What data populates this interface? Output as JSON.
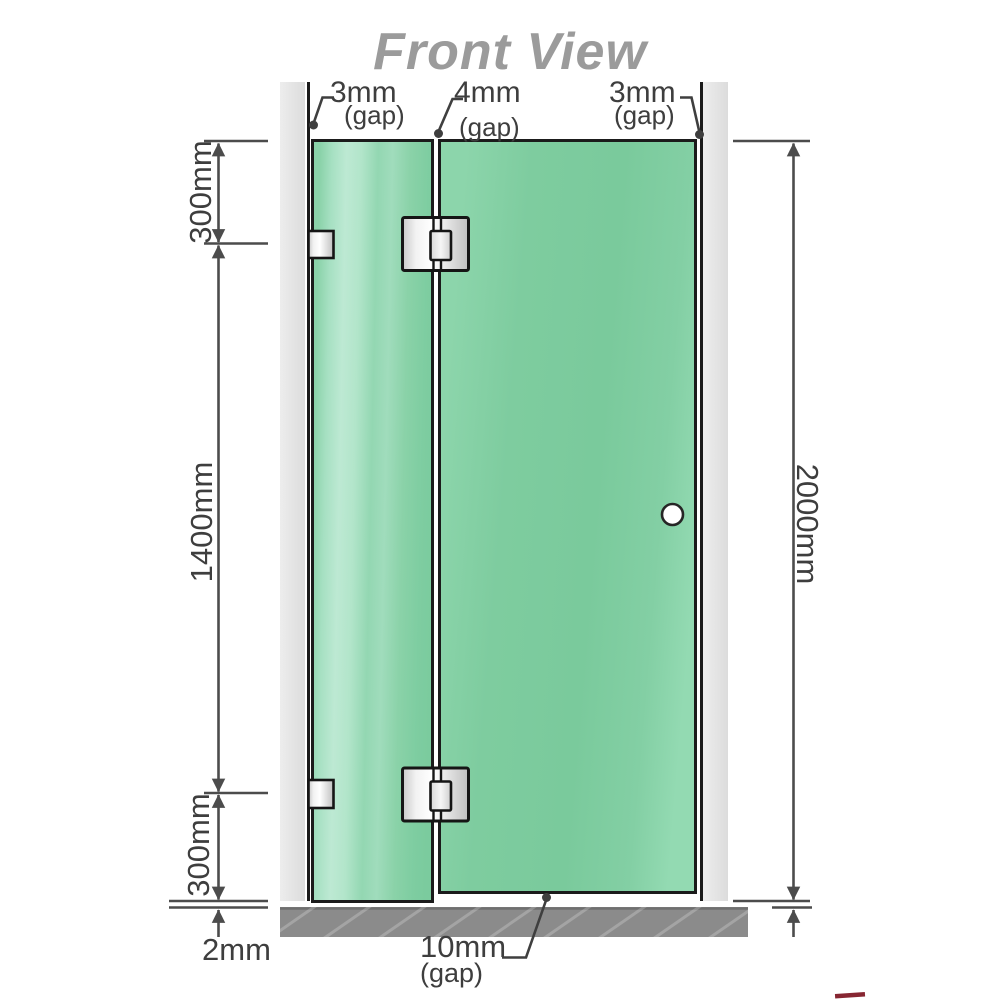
{
  "title": "Front View",
  "gaps_top": [
    {
      "value": "3mm",
      "unit": "(gap)"
    },
    {
      "value": "4mm",
      "unit": "(gap)"
    },
    {
      "value": "3mm",
      "unit": "(gap)"
    }
  ],
  "dimensions": {
    "left_top": "300mm",
    "left_middle": "1400mm",
    "left_bottom": "300mm",
    "floor_clearance": "2mm",
    "right_total": "2000mm"
  },
  "gap_bottom": {
    "value": "10mm",
    "unit": "(gap)"
  },
  "colors": {
    "glass_green": "#7bcb9e",
    "glass_highlight": "#bde9d3",
    "wall_gray": "#e5e5e5",
    "floor_gray": "#8b8b8b",
    "outline_black": "#1a1a1a",
    "dimension_gray": "#4c4c4c",
    "title_gray": "#9b9b9b",
    "hinge_metal": "#e8e8e8",
    "logo_red": "#7a0e1c"
  }
}
